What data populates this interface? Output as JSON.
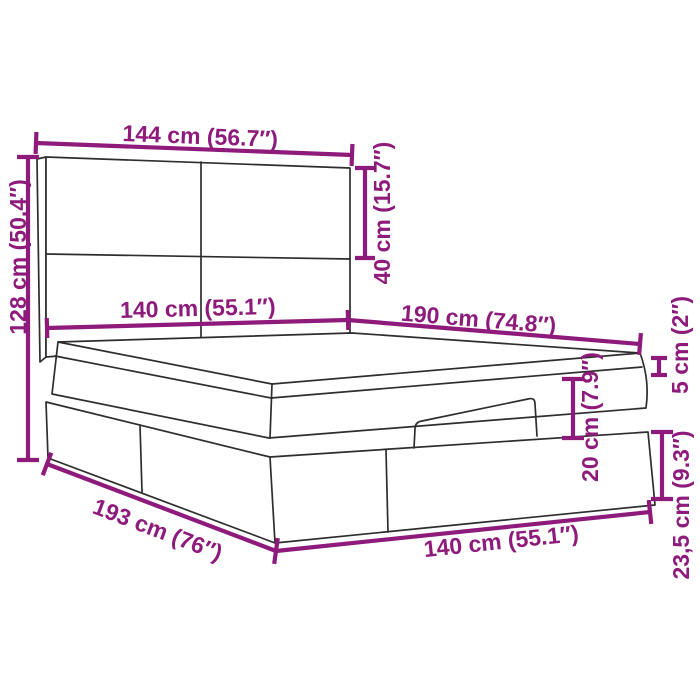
{
  "diagram": {
    "subject": "ottoman-storage-bed-with-headboard-dimension-diagram",
    "accent_color": "#8E1A7C",
    "line_color": "#2e2e2e",
    "background_color": "#ffffff",
    "dimensions": [
      {
        "name": "headboard-width",
        "label": "144 cm (56.7″)"
      },
      {
        "name": "overall-height",
        "label": "128 cm (50.4″)"
      },
      {
        "name": "headboard-upper-panel-height",
        "label": "40 cm (15.7″)"
      },
      {
        "name": "mattress-width",
        "label": "140 cm (55.1″)"
      },
      {
        "name": "bed-length",
        "label": "190 cm (74.8″)"
      },
      {
        "name": "frame-lip-height",
        "label": "5 cm (2″)"
      },
      {
        "name": "mattress-height",
        "label": "20 cm (7.9″)"
      },
      {
        "name": "base-height",
        "label": "23,5 cm (9.3″)"
      },
      {
        "name": "base-length",
        "label": "193 cm (76″)"
      },
      {
        "name": "base-width",
        "label": "140 cm (55.1″)"
      }
    ]
  }
}
